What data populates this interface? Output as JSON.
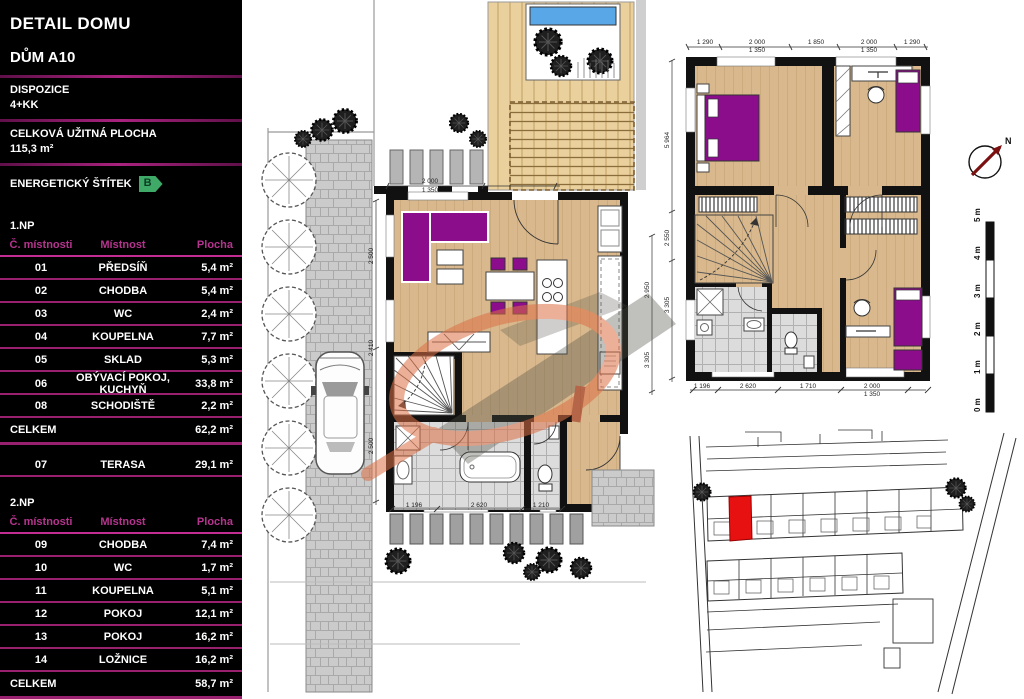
{
  "sidebar": {
    "title": "DETAIL DOMU",
    "subtitle": "DŮM A10",
    "dispozice_label": "DISPOZICE",
    "dispozice_value": "4+KK",
    "plocha_label": "CELKOVÁ UŽITNÁ PLOCHA",
    "plocha_value": "115,3 m²",
    "energy_label": "ENERGETICKÝ ŠTÍTEK",
    "energy_value": "B"
  },
  "floor1": {
    "label": "1.NP",
    "columns": [
      "Č. místnosti",
      "Místnost",
      "Plocha"
    ],
    "rows": [
      [
        "01",
        "PŘEDSÍŇ",
        "5,4 m²"
      ],
      [
        "02",
        "CHODBA",
        "5,4 m²"
      ],
      [
        "03",
        "WC",
        "2,4 m²"
      ],
      [
        "04",
        "KOUPELNA",
        "7,7 m²"
      ],
      [
        "05",
        "SKLAD",
        "5,3 m²"
      ],
      [
        "06",
        "OBÝVACÍ POKOJ, KUCHYŇ",
        "33,8 m²"
      ],
      [
        "08",
        "SCHODIŠTĚ",
        "2,2 m²"
      ]
    ],
    "total_label": "CELKEM",
    "total_value": "62,2 m²",
    "terrace_row": [
      "07",
      "TERASA",
      "29,1 m²"
    ]
  },
  "floor2": {
    "label": "2.NP",
    "columns": [
      "Č. místnosti",
      "Místnost",
      "Plocha"
    ],
    "rows": [
      [
        "09",
        "CHODBA",
        "7,4 m²"
      ],
      [
        "10",
        "WC",
        "1,7 m²"
      ],
      [
        "11",
        "KOUPELNA",
        "5,1 m²"
      ],
      [
        "12",
        "POKOJ",
        "12,1 m²"
      ],
      [
        "13",
        "POKOJ",
        "16,2 m²"
      ],
      [
        "14",
        "LOŽNICE",
        "16,2 m²"
      ]
    ],
    "total_label": "CELKEM",
    "total_value": "58,7 m²"
  },
  "plan_dims": {
    "upper_top": [
      "1 290",
      "2 000",
      "1 850",
      "2 000",
      "1 290"
    ],
    "upper_top_sub": [
      "1 350",
      "1 350"
    ],
    "upper_left": [
      "5 964",
      "2 550",
      "3 305"
    ],
    "upper_bottom": [
      "1 196",
      "2 620",
      "1 710",
      "2 000"
    ],
    "upper_bottom_sub": [
      "1 350"
    ],
    "ground_top": [
      "2 000",
      "1 350"
    ],
    "ground_bottom": [
      "1 196",
      "2 620",
      "1 210"
    ],
    "ground_left": [
      "2 500",
      "2 410",
      "2 500"
    ],
    "ground_right": [
      "2 950",
      "3 305"
    ]
  },
  "compass": {
    "label": "N"
  },
  "scale_bar": {
    "labels": [
      "0 m",
      "1 m",
      "2 m",
      "3 m",
      "4 m",
      "5 m"
    ]
  },
  "colors": {
    "accent_magenta": "#c22d93",
    "separator_magenta": "#99206f",
    "energy_green": "#3fa968",
    "furniture_purple": "#8c0d8c",
    "wood_floor": "#d8b88c",
    "deck_wood": "#e9d09c",
    "tile_gray": "#dcdcdc",
    "site_highlight_red": "#e81111",
    "watermark_orange": "#dd6f44",
    "pool_blue": "#5aa7e8"
  }
}
